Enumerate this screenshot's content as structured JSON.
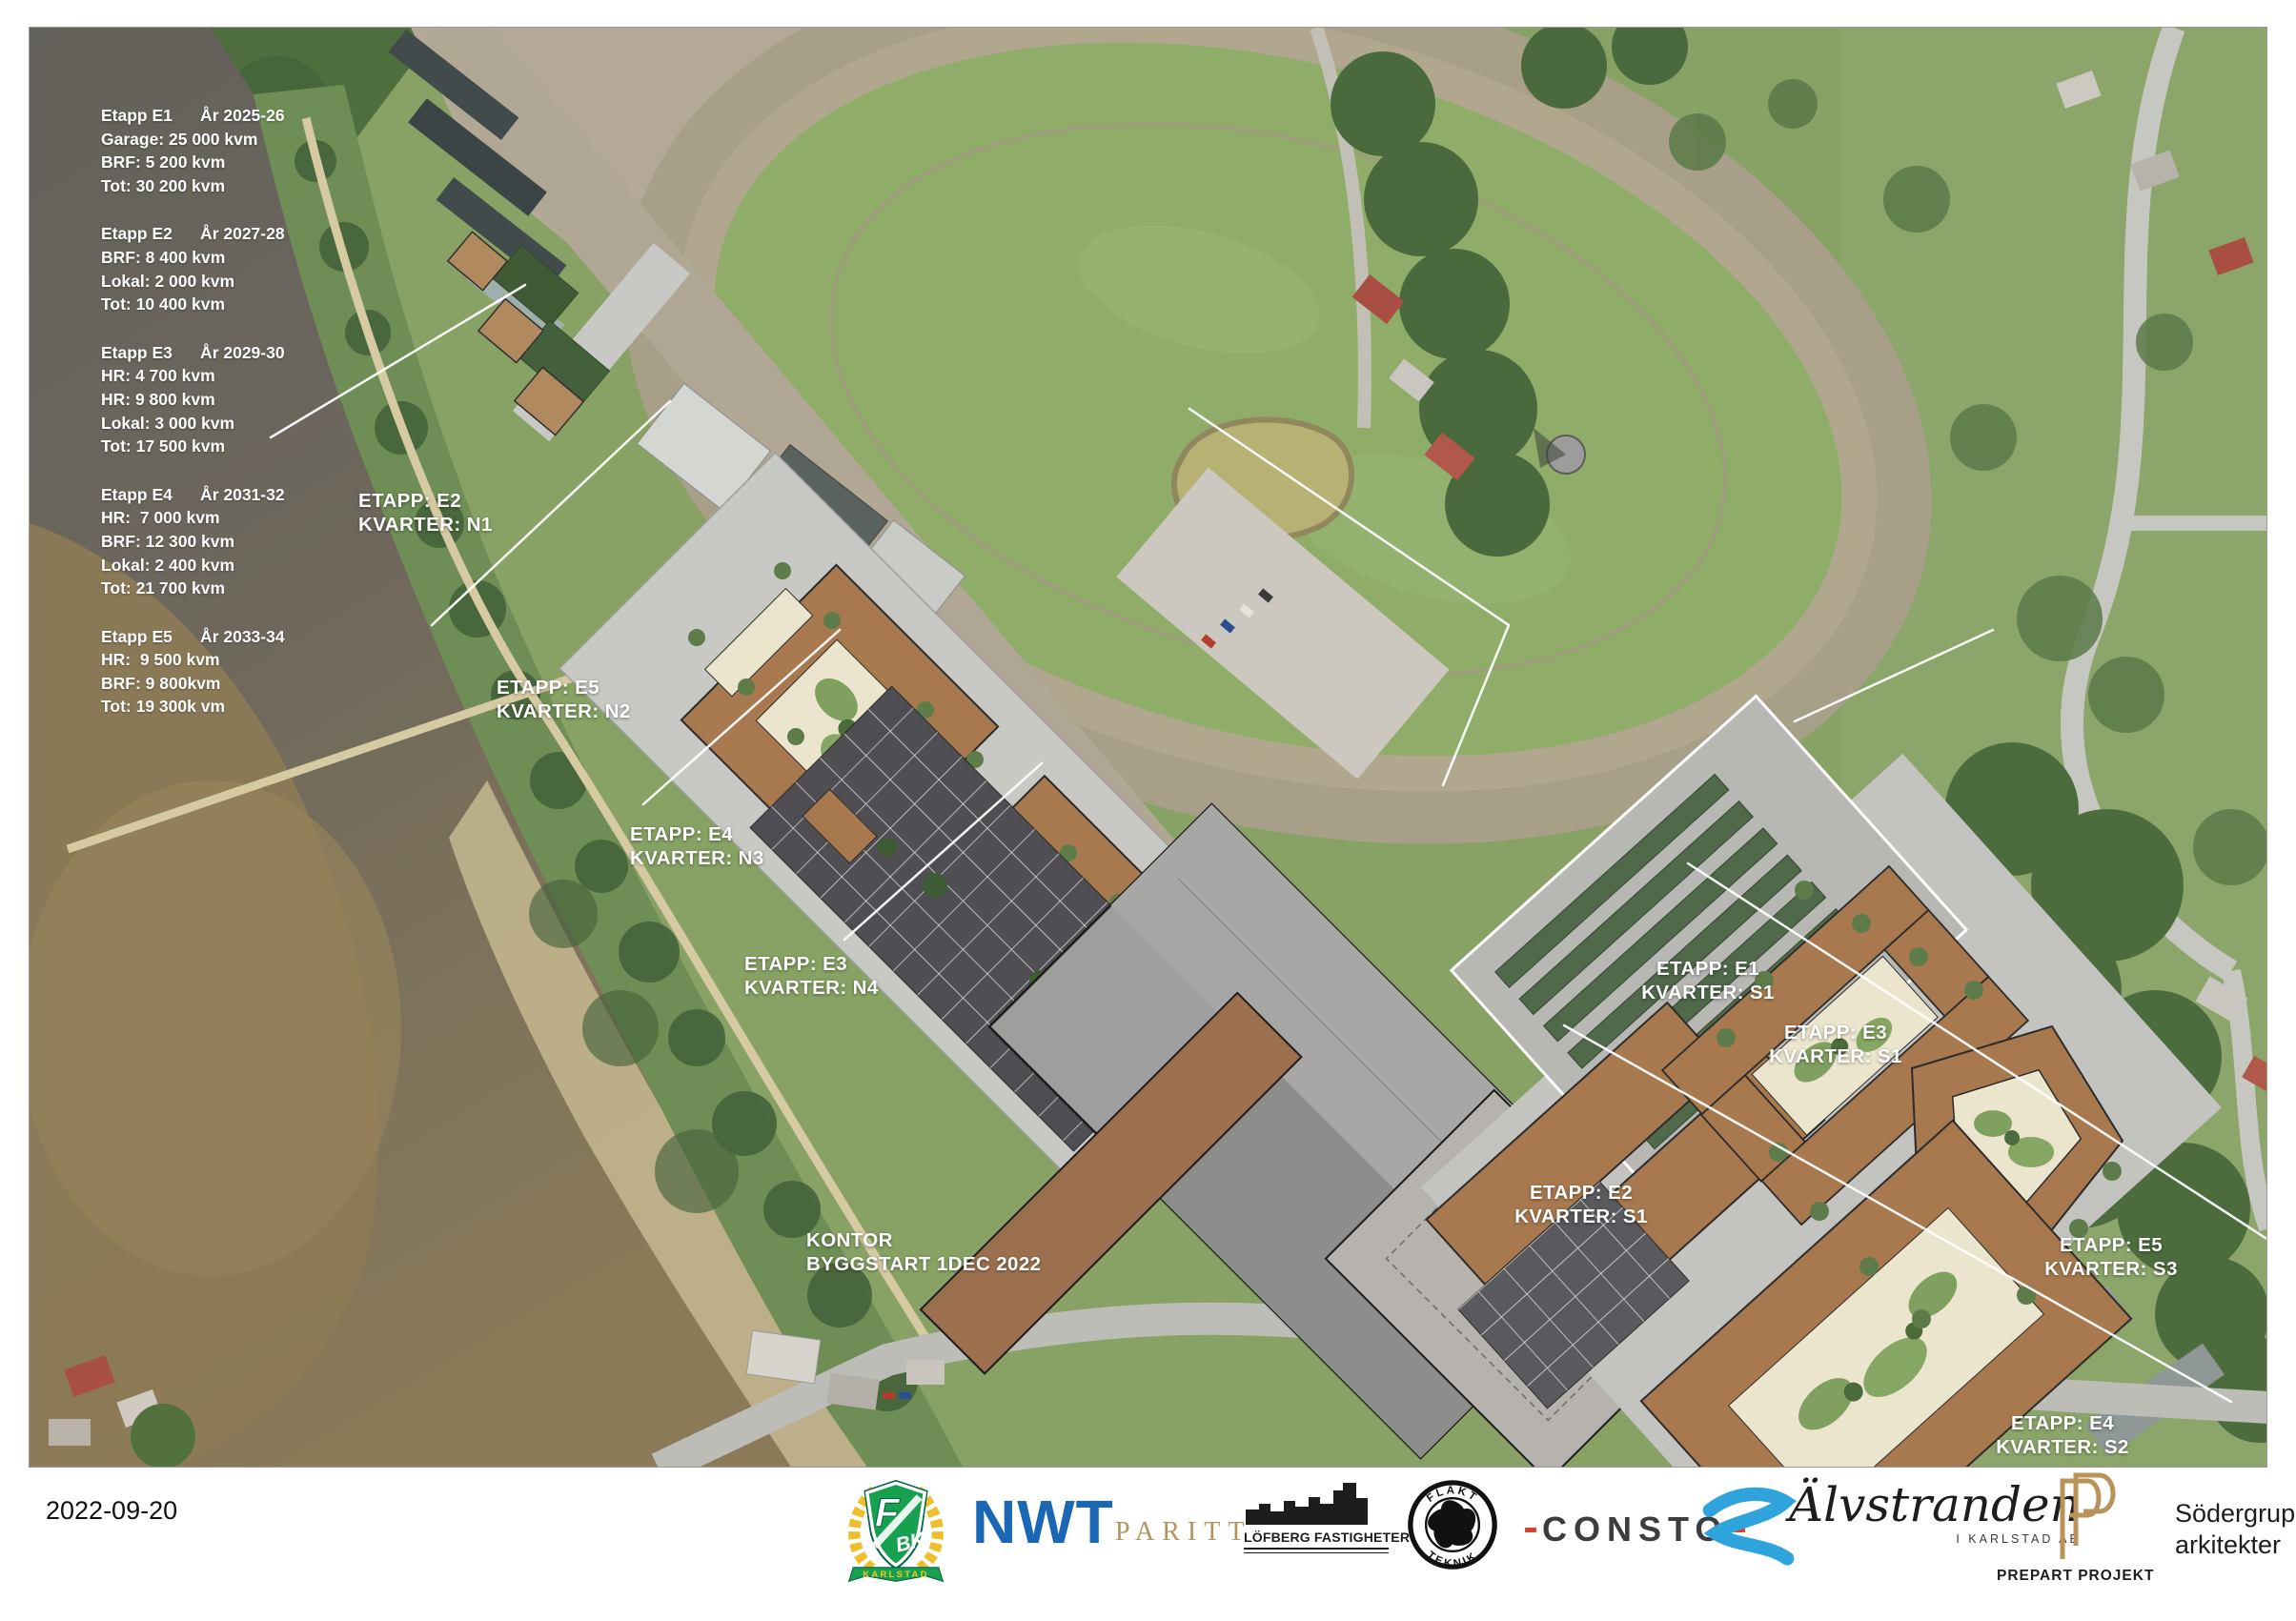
{
  "stage_summaries": [
    {
      "lines": [
        "Etapp E1      År 2025-26",
        "Garage: 25 000 kvm",
        "BRF: 5 200 kvm",
        "Tot: 30 200 kvm"
      ]
    },
    {
      "lines": [
        "Etapp E2      År 2027-28",
        "BRF: 8 400 kvm",
        "Lokal: 2 000 kvm",
        "Tot: 10 400 kvm"
      ]
    },
    {
      "lines": [
        "Etapp E3      År 2029-30",
        "HR: 4 700 kvm",
        "HR: 9 800 kvm",
        "Lokal: 3 000 kvm",
        "Tot: 17 500 kvm"
      ]
    },
    {
      "lines": [
        "Etapp E4      År 2031-32",
        "HR:  7 000 kvm",
        "BRF: 12 300 kvm",
        "Lokal: 2 400 kvm",
        "Tot: 21 700 kvm"
      ]
    },
    {
      "lines": [
        "Etapp E5      År 2033-34",
        "HR:  9 500 kvm",
        "BRF: 9 800kvm",
        "Tot: 19 300k vm"
      ]
    }
  ],
  "map_labels": {
    "n1": {
      "l1": "ETAPP: E2",
      "l2": "KVARTER: N1"
    },
    "n2": {
      "l1": "ETAPP: E5",
      "l2": "KVARTER: N2"
    },
    "n3": {
      "l1": "ETAPP: E4",
      "l2": "KVARTER: N3"
    },
    "n4": {
      "l1": "ETAPP: E3",
      "l2": "KVARTER: N4"
    },
    "kontor": {
      "l1": "KONTOR",
      "l2": "BYGGSTART 1DEC 2022"
    },
    "s1e1": {
      "l1": "ETAPP: E1",
      "l2": "KVARTER: S1"
    },
    "s1e3": {
      "l1": "ETAPP: E3",
      "l2": "KVARTER: S1"
    },
    "s1e2": {
      "l1": "ETAPP: E2",
      "l2": "KVARTER: S1"
    },
    "s3e5": {
      "l1": "ETAPP: E5",
      "l2": "KVARTER: S3"
    },
    "s2e4": {
      "l1": "ETAPP: E4",
      "l2": "KVARTER: S2"
    }
  },
  "footer": {
    "date": "2022-09-20",
    "fbk": {
      "f": "F",
      "bk": "BK",
      "banner": "KARLSTAD"
    },
    "nwt": "NWT",
    "paritt": "PARITT",
    "lofberg": "LÖFBERG FASTIGHETER",
    "flakt": {
      "top": "FLÄKT",
      "bottom": "TEKNIK"
    },
    "consto": "CONSTO",
    "alvstranden": {
      "name": "Älvstranden",
      "sub": "I KARLSTAD AB"
    },
    "prepart": "PREPART PROJEKT",
    "sodergruppen": {
      "l1": "Södergruppen",
      "l2": "arkitekter"
    }
  },
  "colors": {
    "brown": "#a8794f",
    "courtyard": "#ece5cd",
    "courtyard_green": "#7fa05e",
    "nwt_blue": "#1a67b5",
    "paritt_gold": "#b3945c",
    "consto_red": "#e23b30",
    "alvstranden_blue": "#2fa3dc",
    "prepart_gold": "#b8935a",
    "fbk_green": "#17a050",
    "fbk_gold": "#eebf2a"
  }
}
